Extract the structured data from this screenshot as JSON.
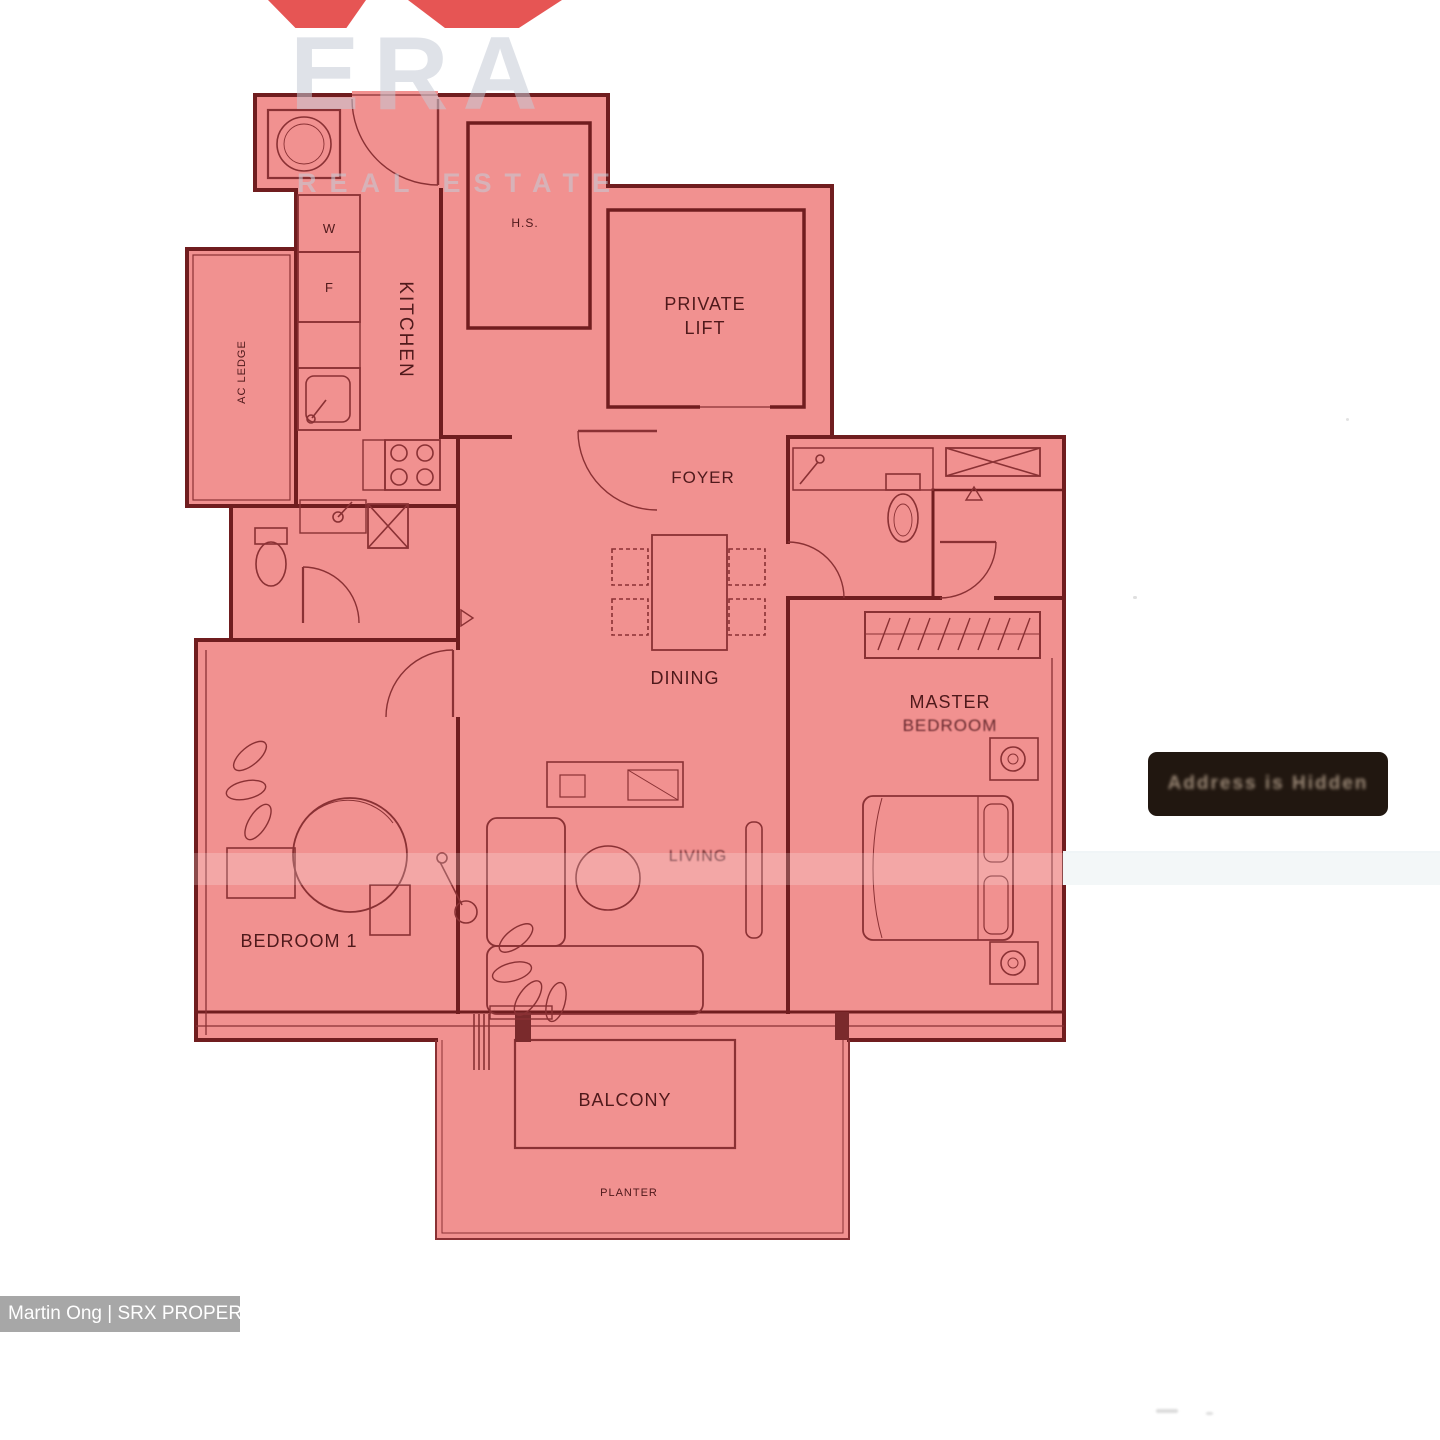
{
  "watermark": {
    "brand": "ERA",
    "subtitle": "REAL ESTATE",
    "red": "#e23e3c"
  },
  "credit": {
    "text": "Martin Ong | SRX PROPERTY"
  },
  "badge": {
    "text": "Address is Hidden",
    "background": "#211710"
  },
  "plan": {
    "colors": {
      "fill": "#f19190",
      "wall": "#701d1f",
      "line": "#8a3134",
      "label": "#4f191b"
    },
    "labels": {
      "washer": "W",
      "fridge": "F",
      "kitchen": "KITCHEN",
      "hs": "H.S.",
      "private_lift_1": "PRIVATE",
      "private_lift_2": "LIFT",
      "foyer": "FOYER",
      "ac_ledge": "AC LEDGE",
      "dining": "DINING",
      "master_1": "MASTER",
      "master_2": "BEDROOM",
      "living": "LIVING",
      "bedroom1": "BEDROOM 1",
      "balcony": "BALCONY",
      "planter": "PLANTER"
    }
  }
}
